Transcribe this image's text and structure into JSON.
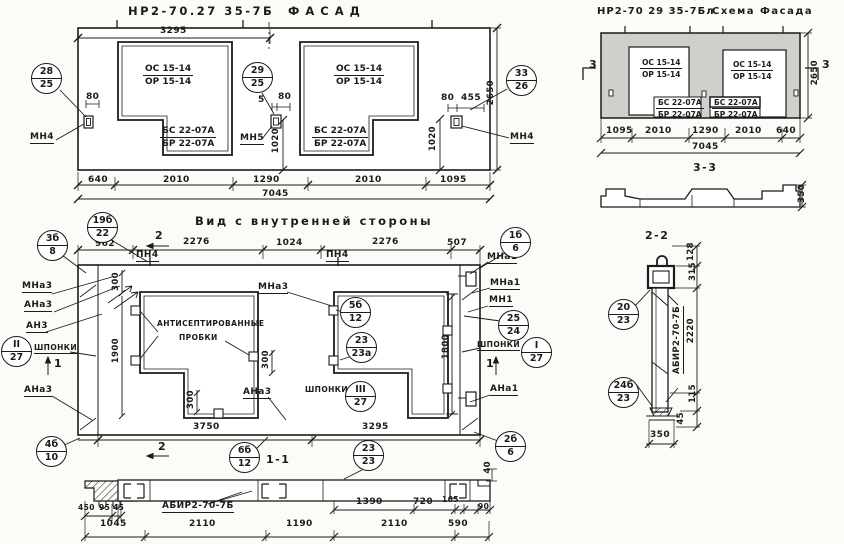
{
  "facade": {
    "title": "НР2-70.27 35-7Б",
    "subtitle": "ФАСАД",
    "panel": {
      "os": "ОС 15-14",
      "or": "ОР 15-14",
      "bs": "БС 22-07А",
      "br": "БР 22-07А"
    },
    "anchors": {
      "mn4": "МН4",
      "mn5": "МН5"
    },
    "callouts": {
      "left": {
        "t": "28",
        "b": "25"
      },
      "mid": {
        "t": "29",
        "b": "25"
      },
      "right": {
        "t": "33",
        "b": "26"
      }
    },
    "dims": {
      "top": "3295",
      "total": "7045",
      "b1": "640",
      "b2": "2010",
      "b3": "1290",
      "b4": "2010",
      "b5": "1095",
      "h": "2650",
      "v1020": "1020",
      "d80": "80",
      "d5": "5",
      "d455": "455"
    }
  },
  "schema": {
    "title": "НР2-70 29 35-7Бл",
    "subtitle": "Схема Фасада",
    "mark3": "3",
    "dims": {
      "b1": "1095",
      "b2": "2010",
      "b3": "1290",
      "b4": "2010",
      "b5": "640",
      "total": "7045",
      "h": "2650"
    },
    "section": {
      "title": "3-3",
      "h": "350"
    }
  },
  "inner": {
    "title": "Вид с внутренней стороны",
    "dims_top": {
      "d1": "962",
      "d2": "2276",
      "d3": "1024",
      "d4": "2276",
      "d5": "507"
    },
    "pn4": "ПН4",
    "marks": {
      "s1": "1",
      "s2": "2"
    },
    "labels": {
      "mna3": "МНа3",
      "ana3": "АНа3",
      "an3": "АН3",
      "shponki": "ШПОНКИ",
      "mna1": "МНа1",
      "mn1": "МН1",
      "ana1": "АНа1",
      "plugs1": "АНТИСЕПТИРОВАННЫЕ",
      "plugs2": "ПРОБКИ"
    },
    "callouts": {
      "c19": {
        "t": "19б",
        "b": "22"
      },
      "c3": {
        "t": "3б",
        "b": "8"
      },
      "c1": {
        "t": "1б",
        "b": "6"
      },
      "c5": {
        "t": "5б",
        "b": "12"
      },
      "c23a": {
        "t": "23",
        "b": "23а"
      },
      "cIII": {
        "t": "III",
        "b": "27"
      },
      "cII": {
        "t": "II",
        "b": "27"
      },
      "c25": {
        "t": "25",
        "b": "24"
      },
      "cI": {
        "t": "I",
        "b": "27"
      },
      "c4": {
        "t": "4б",
        "b": "10"
      },
      "c6": {
        "t": "6б",
        "b": "12"
      },
      "c2": {
        "t": "2б",
        "b": "6"
      }
    },
    "vdims": {
      "v300": "300",
      "v1900": "1900",
      "v1800": "1800"
    },
    "bdims": {
      "b1": "3750",
      "b2": "3295"
    }
  },
  "sec11": {
    "title": "1-1",
    "label": "АБИР2-70-7Б",
    "callout": {
      "t": "23",
      "b": "23"
    },
    "dims": {
      "u1": "450",
      "u2": "95",
      "u3": "45",
      "u4": "1390",
      "u5": "720",
      "u6": "165",
      "u7": "90",
      "v40": "40",
      "b1": "1045",
      "b2": "2110",
      "b3": "1190",
      "b4": "2110",
      "b5": "590"
    }
  },
  "sec22": {
    "title": "2-2",
    "label": "АБИР2-70-7Б",
    "callouts": {
      "c20": {
        "t": "20",
        "b": "23"
      },
      "c24": {
        "t": "24б",
        "b": "23"
      }
    },
    "dims": {
      "d128": "128",
      "d315": "315",
      "d2220": "2220",
      "d115": "115",
      "d45": "45",
      "d350": "350"
    }
  }
}
